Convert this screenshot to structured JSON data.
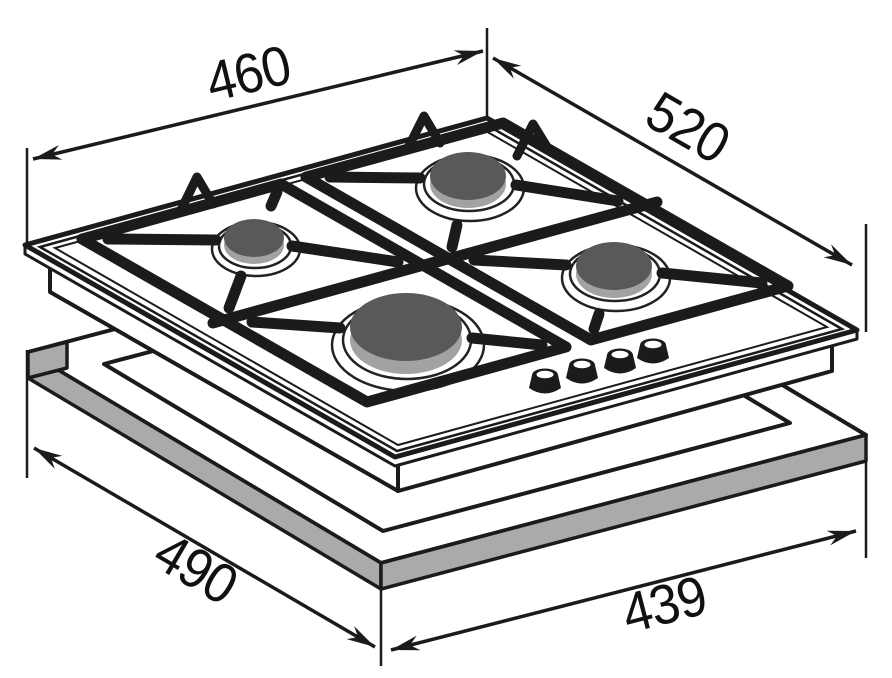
{
  "dims": {
    "top_left": "460",
    "top_right": "520",
    "bottom_left": "490",
    "bottom_right": "439"
  },
  "colors": {
    "line": "#1b1b1b",
    "frame_face": "#a8aaac",
    "burner_cap": "#58595b",
    "burner_skirt": "#a0a2a4",
    "knob": "#1b1b1b",
    "background": "#ffffff"
  }
}
